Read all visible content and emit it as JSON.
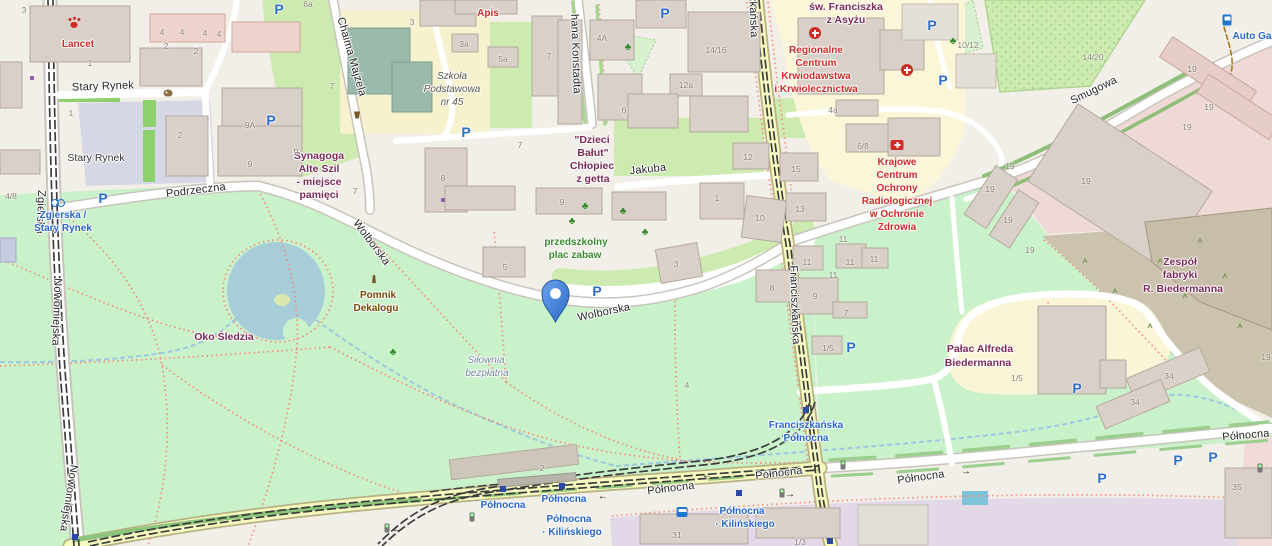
{
  "map": {
    "colors": {
      "park": "#c9f2cb",
      "grass": "#cdebb0",
      "water": "#a6cdd8",
      "stream": "#9fc7dd",
      "land": "#f2efe9",
      "building": "#d9d0c9",
      "road_yellow": "#f7fabf",
      "pedestrian_square": "#d6d7e5",
      "industrial_pink": "#efd9d6",
      "brownfield": "#cbc3ad",
      "education_purple": "#e2d8e8",
      "footpath": "#fa8072",
      "street_text": "#232323",
      "transit_blue": "#2566c9",
      "poi_red": "#cf2b25",
      "poi_plum": "#7c2a56",
      "poi_brown": "#734a08",
      "poi_green": "#3a8a2e",
      "housenumber": "#8a8275",
      "pin_blue": "#3b76d2",
      "parking_blue": "#2e6fce"
    },
    "marker": {
      "name": "location-pin",
      "street": "Wolborska",
      "x": 556,
      "y": 322
    },
    "labels": [
      {
        "t": "Zgierska",
        "x": 40,
        "y": 212,
        "c": "st",
        "r": 92
      },
      {
        "t": "Nowomiejska",
        "x": 56,
        "y": 312,
        "c": "st",
        "r": 92
      },
      {
        "t": "Nowomiejska",
        "x": 68,
        "y": 498,
        "c": "st",
        "r": 99
      },
      {
        "t": "Stary Rynek",
        "x": 103,
        "y": 87,
        "c": "st",
        "r": -2
      },
      {
        "t": "Podrzeczna",
        "x": 196,
        "y": 191,
        "c": "st",
        "r": -7
      },
      {
        "t": "Chaima Majzela",
        "x": 351,
        "y": 57,
        "c": "st",
        "r": 74
      },
      {
        "t": "hana Konstadta",
        "x": 575,
        "y": 54,
        "c": "st",
        "r": 88
      },
      {
        "t": "Wolborska",
        "x": 371,
        "y": 243,
        "c": "st",
        "r": 53
      },
      {
        "t": "Wolborska",
        "x": 604,
        "y": 313,
        "c": "st",
        "r": -12
      },
      {
        "t": "Jakuba",
        "x": 648,
        "y": 170,
        "c": "st",
        "r": -6
      },
      {
        "t": "Franciszkańska",
        "x": 752,
        "y": -2,
        "c": "st",
        "r": 88
      },
      {
        "t": "Franciszkańska",
        "x": 794,
        "y": 305,
        "c": "st",
        "r": 88
      },
      {
        "t": "Smugowa",
        "x": 1094,
        "y": 91,
        "c": "st",
        "r": -26
      },
      {
        "t": "Północna",
        "x": 671,
        "y": 489,
        "c": "st",
        "r": -7
      },
      {
        "t": "Północna",
        "x": 779,
        "y": 474,
        "c": "st",
        "r": -7
      },
      {
        "t": "Północna",
        "x": 921,
        "y": 478,
        "c": "st",
        "r": -8
      },
      {
        "t": "Północna",
        "x": 1246,
        "y": 436,
        "c": "st",
        "r": -5
      },
      {
        "t": "Stary Rynek",
        "x": 96,
        "y": 158,
        "c": "pl"
      },
      {
        "t": "Zgierska /",
        "x": 63,
        "y": 216,
        "c": "tr"
      },
      {
        "t": "Stary Rynek",
        "x": 63,
        "y": 229,
        "c": "tr"
      },
      {
        "t": "Franciszkańska",
        "x": 806,
        "y": 426,
        "c": "tr"
      },
      {
        "t": "Północna",
        "x": 806,
        "y": 439,
        "c": "tr"
      },
      {
        "t": "Północna",
        "x": 503,
        "y": 506,
        "c": "tr"
      },
      {
        "t": "Północna",
        "x": 564,
        "y": 500,
        "c": "tr"
      },
      {
        "t": "Północna",
        "x": 569,
        "y": 520,
        "c": "tr"
      },
      {
        "t": "· Kilińskiego",
        "x": 572,
        "y": 533,
        "c": "tr"
      },
      {
        "t": "Północna",
        "x": 742,
        "y": 512,
        "c": "tr"
      },
      {
        "t": "· Kilińskiego",
        "x": 745,
        "y": 525,
        "c": "tr"
      },
      {
        "t": "Auto Ga",
        "x": 1252,
        "y": 37,
        "c": "tr"
      },
      {
        "t": "Lancet",
        "x": 78,
        "y": 45,
        "c": "rd"
      },
      {
        "t": "Apis",
        "x": 488,
        "y": 14,
        "c": "rd"
      },
      {
        "t": "Regionalne",
        "x": 816,
        "y": 51,
        "c": "rd"
      },
      {
        "t": "Centrum",
        "x": 816,
        "y": 64,
        "c": "rd"
      },
      {
        "t": "Krwiodawstwa",
        "x": 816,
        "y": 77,
        "c": "rd"
      },
      {
        "t": "i Krwiolecznictwa",
        "x": 816,
        "y": 90,
        "c": "rd"
      },
      {
        "t": "Krajowe",
        "x": 897,
        "y": 163,
        "c": "rd"
      },
      {
        "t": "Centrum",
        "x": 897,
        "y": 176,
        "c": "rd"
      },
      {
        "t": "Ochrony",
        "x": 897,
        "y": 189,
        "c": "rd"
      },
      {
        "t": "Radiologicznej",
        "x": 897,
        "y": 202,
        "c": "rd"
      },
      {
        "t": "w Ochronie",
        "x": 897,
        "y": 215,
        "c": "rd"
      },
      {
        "t": "Zdrowia",
        "x": 897,
        "y": 228,
        "c": "rd"
      },
      {
        "t": "św. Franciszka",
        "x": 846,
        "y": 7,
        "c": "pm"
      },
      {
        "t": "z Asyżu",
        "x": 846,
        "y": 20,
        "c": "pm"
      },
      {
        "t": "\"Dzieci",
        "x": 592,
        "y": 140,
        "c": "pm"
      },
      {
        "t": "Bałut\"",
        "x": 593,
        "y": 153,
        "c": "pm"
      },
      {
        "t": "Chłopiec",
        "x": 592,
        "y": 166,
        "c": "pm"
      },
      {
        "t": "z getta",
        "x": 593,
        "y": 179,
        "c": "pm"
      },
      {
        "t": "Synagoga",
        "x": 319,
        "y": 156,
        "c": "pm"
      },
      {
        "t": "Alte Szil",
        "x": 319,
        "y": 169,
        "c": "pm"
      },
      {
        "t": "- miejsce",
        "x": 319,
        "y": 182,
        "c": "pm"
      },
      {
        "t": "pamięci",
        "x": 319,
        "y": 195,
        "c": "pm"
      },
      {
        "t": "Oko Śledzia",
        "x": 224,
        "y": 337,
        "c": "pm"
      },
      {
        "t": "Pałac Alfreda",
        "x": 980,
        "y": 349,
        "c": "pm"
      },
      {
        "t": "Biedermanna",
        "x": 978,
        "y": 363,
        "c": "pm"
      },
      {
        "t": "Zespół",
        "x": 1180,
        "y": 262,
        "c": "pm"
      },
      {
        "t": "fabryki",
        "x": 1180,
        "y": 275,
        "c": "pm"
      },
      {
        "t": "R. Biedermanna",
        "x": 1183,
        "y": 289,
        "c": "pm"
      },
      {
        "t": "Pomnik",
        "x": 378,
        "y": 296,
        "c": "br"
      },
      {
        "t": "Dekalogu",
        "x": 376,
        "y": 309,
        "c": "br"
      },
      {
        "t": "przedszkolny",
        "x": 576,
        "y": 243,
        "c": "gr"
      },
      {
        "t": "plac zabaw",
        "x": 575,
        "y": 256,
        "c": "gr"
      },
      {
        "t": "Siłownia",
        "x": 486,
        "y": 361,
        "c": "gb"
      },
      {
        "t": "bezpłatna",
        "x": 487,
        "y": 374,
        "c": "gb"
      },
      {
        "t": "Szkoła",
        "x": 452,
        "y": 77,
        "c": "sc"
      },
      {
        "t": "Podstawowa",
        "x": 452,
        "y": 90,
        "c": "sc"
      },
      {
        "t": "nr 45",
        "x": 452,
        "y": 103,
        "c": "sc"
      },
      {
        "t": "3",
        "x": 24,
        "y": 10,
        "c": "hn"
      },
      {
        "t": "4",
        "x": 162,
        "y": 32,
        "c": "hn"
      },
      {
        "t": "2",
        "x": 166,
        "y": 46,
        "c": "hn"
      },
      {
        "t": "4",
        "x": 182,
        "y": 32,
        "c": "hn"
      },
      {
        "t": "2",
        "x": 196,
        "y": 51,
        "c": "hn"
      },
      {
        "t": "4",
        "x": 205,
        "y": 33,
        "c": "hn"
      },
      {
        "t": "4",
        "x": 219,
        "y": 34,
        "c": "hn"
      },
      {
        "t": "1",
        "x": 90,
        "y": 63,
        "c": "hn"
      },
      {
        "t": "1",
        "x": 71,
        "y": 113,
        "c": "hn"
      },
      {
        "t": "9A",
        "x": 250,
        "y": 125,
        "c": "hn"
      },
      {
        "t": "2",
        "x": 180,
        "y": 135,
        "c": "hn"
      },
      {
        "t": "9",
        "x": 250,
        "y": 164,
        "c": "hn"
      },
      {
        "t": "9",
        "x": 296,
        "y": 152,
        "c": "hn"
      },
      {
        "t": "4/8",
        "x": 11,
        "y": 196,
        "c": "hn"
      },
      {
        "t": "6a",
        "x": 308,
        "y": 4,
        "c": "hn"
      },
      {
        "t": "3",
        "x": 412,
        "y": 22,
        "c": "hn"
      },
      {
        "t": "3a",
        "x": 464,
        "y": 44,
        "c": "hn"
      },
      {
        "t": "5a",
        "x": 503,
        "y": 59,
        "c": "hn"
      },
      {
        "t": "7",
        "x": 549,
        "y": 56,
        "c": "hn"
      },
      {
        "t": "7",
        "x": 332,
        "y": 86,
        "c": "hn"
      },
      {
        "t": "7",
        "x": 355,
        "y": 191,
        "c": "hn"
      },
      {
        "t": "8",
        "x": 443,
        "y": 178,
        "c": "hn"
      },
      {
        "t": "7",
        "x": 520,
        "y": 145,
        "c": "hn"
      },
      {
        "t": "9",
        "x": 562,
        "y": 202,
        "c": "hn"
      },
      {
        "t": "4A",
        "x": 602,
        "y": 38,
        "c": "hn"
      },
      {
        "t": "6",
        "x": 624,
        "y": 110,
        "c": "hn"
      },
      {
        "t": "14/16",
        "x": 716,
        "y": 50,
        "c": "hn"
      },
      {
        "t": "12a",
        "x": 686,
        "y": 85,
        "c": "hn"
      },
      {
        "t": "12",
        "x": 748,
        "y": 157,
        "c": "hn"
      },
      {
        "t": "15",
        "x": 796,
        "y": 169,
        "c": "hn"
      },
      {
        "t": "13",
        "x": 800,
        "y": 209,
        "c": "hn"
      },
      {
        "t": "10",
        "x": 760,
        "y": 218,
        "c": "hn"
      },
      {
        "t": "1",
        "x": 717,
        "y": 198,
        "c": "hn"
      },
      {
        "t": "3",
        "x": 676,
        "y": 264,
        "c": "hn"
      },
      {
        "t": "8",
        "x": 772,
        "y": 288,
        "c": "hn"
      },
      {
        "t": "9",
        "x": 815,
        "y": 296,
        "c": "hn"
      },
      {
        "t": "11",
        "x": 807,
        "y": 262,
        "c": "hn"
      },
      {
        "t": "11",
        "x": 850,
        "y": 262,
        "c": "hn"
      },
      {
        "t": "11",
        "x": 833,
        "y": 275,
        "c": "hn"
      },
      {
        "t": "11",
        "x": 874,
        "y": 259,
        "c": "hn"
      },
      {
        "t": "11",
        "x": 843,
        "y": 239,
        "c": "hn"
      },
      {
        "t": "7",
        "x": 846,
        "y": 313,
        "c": "hn"
      },
      {
        "t": "1/5",
        "x": 828,
        "y": 348,
        "c": "hn"
      },
      {
        "t": "1/5",
        "x": 1017,
        "y": 378,
        "c": "hn"
      },
      {
        "t": "4a",
        "x": 833,
        "y": 110,
        "c": "hn"
      },
      {
        "t": "6/8",
        "x": 863,
        "y": 146,
        "c": "hn"
      },
      {
        "t": "10/12",
        "x": 968,
        "y": 45,
        "c": "hn"
      },
      {
        "t": "14/20",
        "x": 1093,
        "y": 57,
        "c": "hn"
      },
      {
        "t": "19",
        "x": 1192,
        "y": 69,
        "c": "hn"
      },
      {
        "t": "19",
        "x": 1209,
        "y": 107,
        "c": "hn"
      },
      {
        "t": "19",
        "x": 1187,
        "y": 127,
        "c": "hn"
      },
      {
        "t": "19",
        "x": 1086,
        "y": 181,
        "c": "hn"
      },
      {
        "t": "19",
        "x": 1010,
        "y": 166,
        "c": "hn"
      },
      {
        "t": "19",
        "x": 990,
        "y": 189,
        "c": "hn"
      },
      {
        "t": "19",
        "x": 1008,
        "y": 220,
        "c": "hn"
      },
      {
        "t": "19",
        "x": 1030,
        "y": 250,
        "c": "hn"
      },
      {
        "t": "19",
        "x": 1266,
        "y": 357,
        "c": "hn"
      },
      {
        "t": "34",
        "x": 1169,
        "y": 376,
        "c": "hn"
      },
      {
        "t": "34",
        "x": 1135,
        "y": 402,
        "c": "hn"
      },
      {
        "t": "35",
        "x": 1237,
        "y": 487,
        "c": "hn"
      },
      {
        "t": "31",
        "x": 677,
        "y": 535,
        "c": "hn"
      },
      {
        "t": "1/3",
        "x": 800,
        "y": 542,
        "c": "hn"
      },
      {
        "t": "2",
        "x": 542,
        "y": 468,
        "c": "hn"
      },
      {
        "t": "5",
        "x": 505,
        "y": 267,
        "c": "hn"
      },
      {
        "t": "4",
        "x": 687,
        "y": 385,
        "c": "hn"
      }
    ],
    "icons": [
      {
        "k": "parking",
        "t": "P",
        "x": 279,
        "y": 9
      },
      {
        "k": "parking",
        "t": "P",
        "x": 665,
        "y": 13
      },
      {
        "k": "parking",
        "t": "P",
        "x": 103,
        "y": 198
      },
      {
        "k": "parking",
        "t": "P",
        "x": 271,
        "y": 120
      },
      {
        "k": "parking",
        "t": "P",
        "x": 466,
        "y": 132
      },
      {
        "k": "parking",
        "t": "P",
        "x": 597,
        "y": 291
      },
      {
        "k": "parking",
        "t": "P",
        "x": 932,
        "y": 25
      },
      {
        "k": "parking",
        "t": "P",
        "x": 943,
        "y": 80
      },
      {
        "k": "parking",
        "t": "P",
        "x": 851,
        "y": 347
      },
      {
        "k": "parking",
        "t": "P",
        "x": 1077,
        "y": 388
      },
      {
        "k": "parking",
        "t": "P",
        "x": 1102,
        "y": 478
      },
      {
        "k": "parking",
        "t": "P",
        "x": 1178,
        "y": 460
      },
      {
        "k": "parking",
        "t": "P",
        "x": 1213,
        "y": 457
      },
      {
        "k": "tstop",
        "x": 503,
        "y": 489
      },
      {
        "k": "tstop",
        "x": 562,
        "y": 486
      },
      {
        "k": "tstop",
        "x": 739,
        "y": 493
      },
      {
        "k": "tstop",
        "x": 830,
        "y": 541
      },
      {
        "k": "tstop",
        "x": 806,
        "y": 410
      },
      {
        "k": "tstop",
        "x": 75,
        "y": 537
      },
      {
        "k": "tlight",
        "x": 472,
        "y": 517
      },
      {
        "k": "tlight",
        "x": 782,
        "y": 493
      },
      {
        "k": "tlight",
        "x": 843,
        "y": 465
      },
      {
        "k": "tlight",
        "x": 387,
        "y": 528
      },
      {
        "k": "tlight",
        "x": 1260,
        "y": 468
      },
      {
        "k": "arrow",
        "t": "←",
        "x": 603,
        "y": 497
      },
      {
        "k": "arrow",
        "t": "←",
        "x": 707,
        "y": 476
      },
      {
        "k": "arrow",
        "t": "→",
        "x": 966,
        "y": 472
      },
      {
        "k": "arrow",
        "t": "→",
        "x": 790,
        "y": 495
      },
      {
        "k": "arrow",
        "t": "←",
        "x": 397,
        "y": 530
      },
      {
        "k": "bus",
        "x": 682,
        "y": 512
      },
      {
        "k": "bike",
        "x": 58,
        "y": 202
      },
      {
        "k": "fuel",
        "x": 1227,
        "y": 20
      },
      {
        "k": "paw",
        "x": 74,
        "y": 25
      },
      {
        "k": "cross",
        "x": 815,
        "y": 33
      },
      {
        "k": "cross",
        "x": 907,
        "y": 70
      },
      {
        "k": "firstaid",
        "x": 897,
        "y": 145
      },
      {
        "k": "artwork",
        "x": 168,
        "y": 93
      },
      {
        "k": "basket",
        "x": 357,
        "y": 115
      },
      {
        "k": "monument",
        "x": 374,
        "y": 279
      },
      {
        "k": "shopdot",
        "x": 32,
        "y": 78
      },
      {
        "k": "shopdot",
        "x": 443,
        "y": 200
      },
      {
        "k": "pg",
        "t": "♣",
        "x": 628,
        "y": 48
      },
      {
        "k": "pg",
        "t": "♣",
        "x": 953,
        "y": 42
      },
      {
        "k": "pg",
        "t": "♣",
        "x": 585,
        "y": 207
      },
      {
        "k": "pg",
        "t": "♣",
        "x": 623,
        "y": 212
      },
      {
        "k": "pg",
        "t": "♣",
        "x": 645,
        "y": 233
      },
      {
        "k": "pg",
        "t": "♣",
        "x": 572,
        "y": 222
      },
      {
        "k": "pg",
        "t": "♣",
        "x": 393,
        "y": 353
      }
    ]
  }
}
